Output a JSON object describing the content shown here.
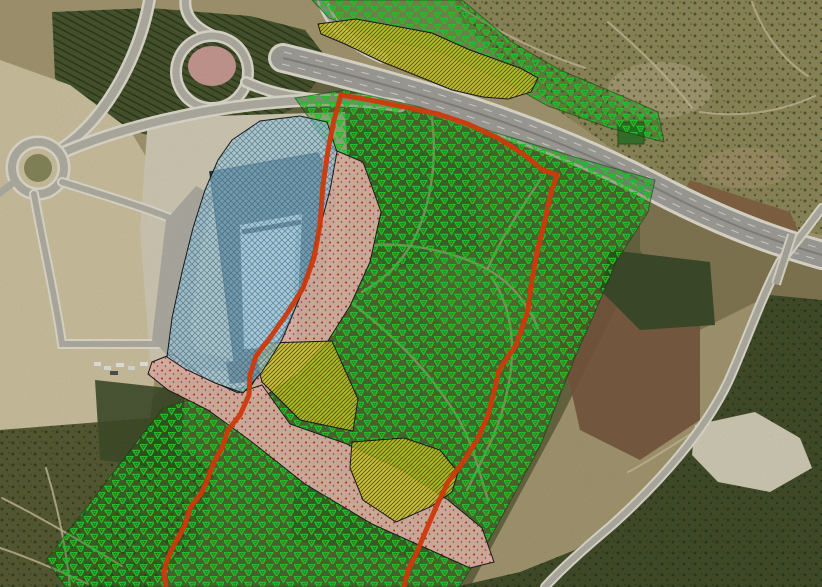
{
  "map": {
    "title": "aerial-orthophoto-planning-map",
    "description": "Satellite orthophoto with GIS planning overlay layers: red site boundary, green vegetation triangle hatch, yellow diagonal-hatch parcels, blue cross-hatch building zone, pink stippled bare-soil strip",
    "layers": {
      "boundary": {
        "name": "site-boundary-line",
        "color": "#e8400e",
        "lines": {
          "west": {
            "points": "341,95 334,120 328,150 323,185 320,225 314,258 303,288 288,312 272,335 256,356 250,375 249,395 240,415 228,430 222,448 214,462 208,478 202,492 190,508 185,525 175,543 168,558 164,572 166,587"
          },
          "east": {
            "points": "341,95 370,100 405,107 438,114 468,124 498,138 523,154 543,170 557,175 551,192 545,220 537,252 531,285 528,310 516,345 499,370 494,392 488,415 477,440 463,462 448,482 437,505 427,528 417,552 408,570 404,587"
          }
        }
      },
      "vegetation": {
        "name": "vegetation-triangle-hatch",
        "wash_color": "rgba(10,115,10,0.32)",
        "glyph_color": "#2bd32c",
        "outline": "rgba(20,60,20,0.55)",
        "polygons": {
          "north_strip": "312,0 462,0 512,42 560,70 622,96 658,112 664,142 610,128 548,106 500,79 440,52 378,38 329,18",
          "main": "295,98 345,90 420,107 500,134 575,157 655,180 648,212 616,262 598,305 576,355 558,400 541,444 512,498 488,542 470,570 459,587 66,587 46,560 163,408 190,400 252,385 290,350 308,290 318,220 330,148"
        }
      },
      "yellow_parcels": {
        "name": "yellow-diagonal-hatch-parcels",
        "fill": "rgba(228,222,48,0.78)",
        "hatch_color": "rgba(70,70,20,0.8)",
        "outline": "#2a2a12",
        "polygons": {
          "north": "318,24 356,19 400,27 432,33 470,50 520,68 538,78 531,92 508,99 483,97 452,90 420,77 380,61 345,44 321,34",
          "mid": "256,358 268,343 332,341 358,399 353,431 338,428 300,420 262,382",
          "south": "352,442 404,438 440,450 458,472 452,492 430,507 396,522 363,500 350,468"
        }
      },
      "blue_zone": {
        "name": "building-site-crosshatch-zone",
        "fill": "rgba(180,223,240,0.66)",
        "hatch_color": "rgba(30,90,130,0.5)",
        "outline": "#27353d",
        "polygons": {
          "site": "232,140 260,121 300,116 327,122 337,152 330,190 318,235 303,290 282,340 262,372 243,393 215,383 185,369 167,357 172,318 182,272 193,228 205,190 218,160"
        }
      },
      "pink_strip": {
        "name": "bare-soil-stipple-strip",
        "fill": "rgba(238,190,180,0.93)",
        "dot_color": "#c33014",
        "dot_color2": "#8a5040",
        "outline": "#33221d",
        "polygons": {
          "east_of_site": "330,148 363,162 381,212 370,262 350,306 326,344 298,374 268,394 243,400 262,368 285,330 303,290 315,240 322,195 322,160",
          "south_band": "152,362 172,354 205,378 238,393 262,385 290,424 347,444 402,470 448,500 482,528 494,562 470,568 430,550 372,524 305,484 252,442 208,410 168,390 148,374"
        }
      }
    }
  }
}
